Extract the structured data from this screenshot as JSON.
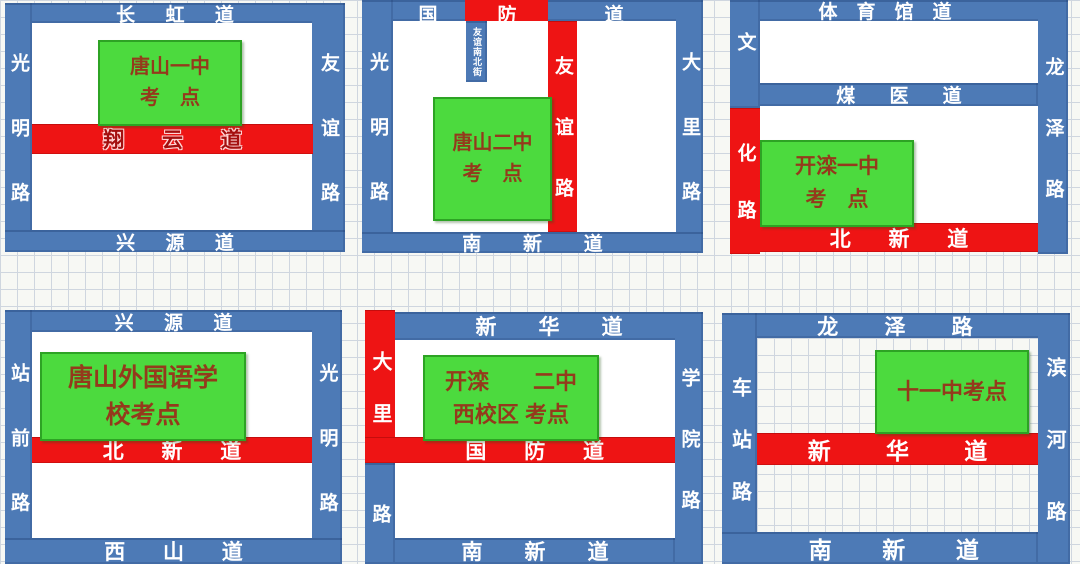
{
  "colors": {
    "road_blue": "#4d7ab6",
    "road_red": "#ee1414",
    "venue_green": "#4cda3e",
    "venue_text_red": "#943a1c",
    "label_white": "#ffffff",
    "halo_text_red": "#a40f0f"
  },
  "panels": [
    {
      "name": "唐山一中考点",
      "venue_label": "唐山一中\n考　点",
      "roads": {
        "top": "长虹道",
        "bottom": "兴源道",
        "left": "光明路",
        "right": "友谊路",
        "middle": "翔云道"
      }
    },
    {
      "name": "唐山二中考点",
      "venue_label": "唐山二中\n考　点",
      "roads": {
        "top_char_1": "国",
        "top_char_2": "防",
        "top_char_3": "道",
        "left": "光明路",
        "right": "大里路",
        "middle_vertical": "友谊路",
        "bottom": "南新道",
        "small_street": "友谊南北街"
      }
    },
    {
      "name": "开滦一中考点",
      "venue_label": "开滦一中\n考　点",
      "roads": {
        "top": "体育馆道",
        "left_blue_part": "文",
        "left_red_part": "化路",
        "right": "龙泽路",
        "middle": "煤医道",
        "bottom": "北新道"
      }
    },
    {
      "name": "唐山外国语学校考点",
      "venue_label": "唐山外国语学\n校考点",
      "roads": {
        "top": "兴源道",
        "left": "站前路",
        "right": "光明路",
        "middle": "北新道",
        "bottom": "西山道"
      }
    },
    {
      "name": "开滦二中西校区考点",
      "venue_label": "开滦　　二中\n西校区 考点",
      "roads": {
        "top": "新华道",
        "left_red_part": "大里",
        "left_blue_part": "路",
        "right": "学院路",
        "middle": "国防道",
        "bottom": "南新道"
      }
    },
    {
      "name": "十一中考点",
      "venue_label": "十一中考点",
      "roads": {
        "top": "龙泽路",
        "left": "车站路",
        "right": "滨河路",
        "middle": "新华道",
        "bottom": "南新道"
      }
    }
  ]
}
